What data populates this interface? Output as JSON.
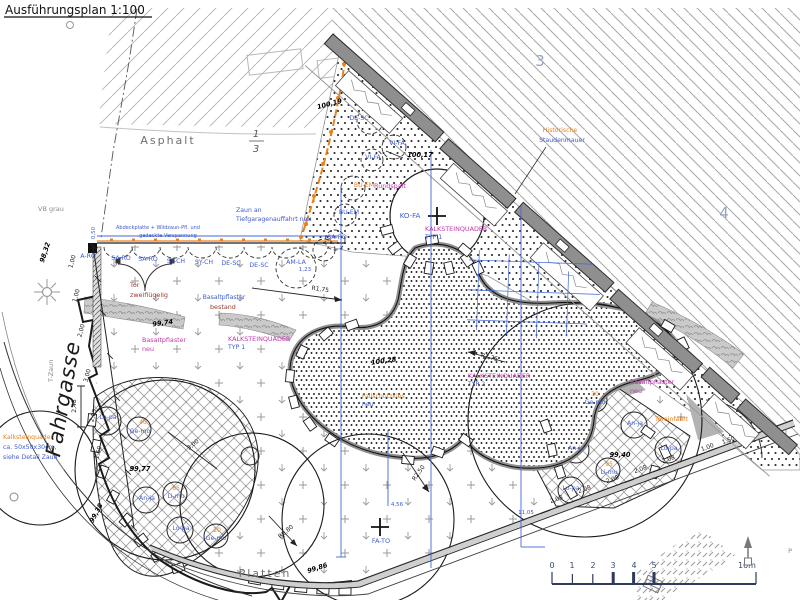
{
  "title": "Ausführungsplan 1:100",
  "street": "Fahrgasse",
  "areas": {
    "asphalt": "Asphalt",
    "platten": "Platten",
    "vb_grau": "VB grau",
    "frac_num": "1",
    "frac_den": "3",
    "parcel_3": "3",
    "parcel_4": "4",
    "p_edge": "P"
  },
  "notes": {
    "zaun_l1": "Zaun an",
    "zaun_l2": "Tiefgaragenauffahrt neu",
    "abdeck_l1": "Abdeckplatte + Wildzaun-Pfl. und",
    "abdeck_l2": "gedeckte Verspannung",
    "tor_l1": "Tor",
    "tor_l2": "zweiflügelig",
    "basalt_bestand_l1": "Basaltpflaster",
    "basalt_bestand_l2": "bestand",
    "basalt_neu_l1": "Basaltpflaster",
    "basalt_neu_l2": "neu",
    "toreinfahrt": "Toreinfahrt",
    "mauer_l1": "Historische",
    "mauer_l2": "Staudenmauer",
    "rundspalt": "Rundspalt",
    "fallschutz_l1": "Fallschutzkies",
    "fallschutz_l2": "neu",
    "kalk_detail_l1": "Kalksteinquader",
    "kalk_detail_l2": "ca. 50x50x30cm,",
    "kalk_detail_l3": "siehe Detail Zaun",
    "t_zaun": "T-Zaun"
  },
  "materials": {
    "kalk": "KALKSTEINQUADER",
    "typ1": "TYP 1",
    "typ2": "TYP 2"
  },
  "plant_row": [
    "A-RO",
    "SA-RO",
    "SA-RO",
    "SY-CH",
    "SY-CH",
    "DE-SC",
    "DE-SC",
    "AM-LA"
  ],
  "plants_upper": [
    "DE-SC",
    "VI-FA",
    "VI-FA",
    "BU-EM",
    "BU-EM",
    "SA-RO"
  ],
  "trees": {
    "ko_fa": "KO-FA",
    "fa_to": "FA-TO"
  },
  "left_bed": {
    "p1": "Lo-pa",
    "q2": "40",
    "p2": "Ge-mo",
    "p3": "An-ja",
    "q4": "85",
    "p4": "Li-mu",
    "p5": "Lo-pa",
    "q6": "20",
    "p6": "Ge-mo"
  },
  "right_bed": {
    "q1": "30",
    "p1": "Ge-mo",
    "p2": "An-ja",
    "p3": "An-ja",
    "p4": "Lo-pa",
    "q5": "95",
    "p5": "Li-mu",
    "p6": "Lo-pa"
  },
  "elevations": {
    "e1": "100,19",
    "e2": "100,17",
    "e3": "99,74",
    "e4": "100,28",
    "e5": "99,77",
    "e6": "99,40",
    "e7": "99,86",
    "e8": "98,32",
    "e9": "99,38"
  },
  "dims": {
    "d1": "1,00",
    "d2": "1,00",
    "d3": "2,00",
    "d4": "3,00",
    "d5": "2,05",
    "d6": "1,50",
    "d248": "2,48",
    "d300": "3,00",
    "r175": "R1,75",
    "r275": "R2,75",
    "r250": "R2,50",
    "r080": "R0,80",
    "d208": "2,08",
    "d100": "1,00",
    "d150": "1,50",
    "d050": "0,50",
    "b123": "1,23",
    "b456": "4,56",
    "b1105": "11,05"
  },
  "scalebar": {
    "t0": "0",
    "t1": "1",
    "t2": "2",
    "t3": "3",
    "t4": "4",
    "t5": "5",
    "t10": "10m"
  }
}
